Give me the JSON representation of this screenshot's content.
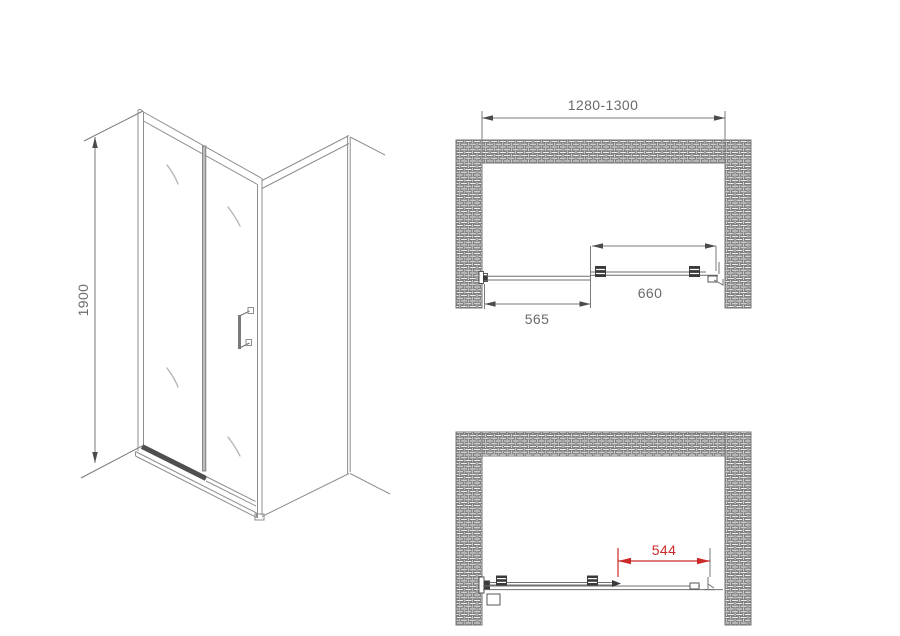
{
  "meta": {
    "title": "Sliding shower door technical drawing",
    "canvas_width": 900,
    "canvas_height": 636,
    "background": "#ffffff"
  },
  "colors": {
    "line_gray": "#8e8e8e",
    "dark_gray": "#4a4a4a",
    "hardware_dark": "#3a3a3a",
    "text_gray": "#6b6b6b",
    "accent_red": "#cc2a28",
    "brick_stroke": "#4d4d4d"
  },
  "views": {
    "isometric": {
      "name": "isometric view of sliding shower door with side panel",
      "dimensions": [
        {
          "id": "door-height",
          "label": "1900",
          "orientation": "vertical"
        }
      ]
    },
    "plan_closed": {
      "name": "plan view between brick walls, door closed",
      "dimensions": [
        {
          "id": "opening-width",
          "label": "1280-1300"
        },
        {
          "id": "sliding-panel-width",
          "label": "660"
        },
        {
          "id": "fixed-panel-width",
          "label": "565"
        }
      ]
    },
    "plan_open": {
      "name": "plan view between brick walls, door open",
      "dimensions": [
        {
          "id": "walk-in-clearance",
          "label": "544",
          "color": "#cc2a28"
        }
      ]
    }
  }
}
